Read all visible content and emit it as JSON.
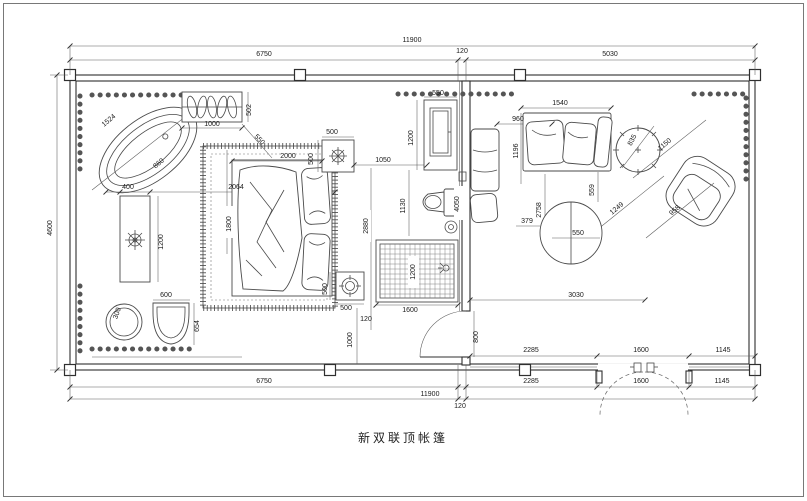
{
  "title": "新双联顶帐篷",
  "colors": {
    "line": "#2f2f2f",
    "dim_line": "#5a5a5a",
    "text": "#1a1a1a",
    "background": "#ffffff"
  },
  "dims": {
    "top_total": "11900",
    "top_left": "6750",
    "top_mid": "120",
    "top_right": "5030",
    "left_height": "4600",
    "bottom_left": "6750",
    "bottom_total": "11900",
    "bottom_mid": "120",
    "win_inner": [
      "2285",
      "1600",
      "1145"
    ],
    "win_outer": [
      "2285",
      "1600",
      "1145"
    ]
  },
  "interior": {
    "tub_length": "1524",
    "tub_width": "860",
    "rack_width": "1000",
    "rack_depth": "502",
    "rack_offset": "550",
    "console_width": "400",
    "console_length": "1200",
    "console_to_bed": "2064",
    "carpet_length": "1800",
    "pouf_dia": "300",
    "seat_width": "600",
    "seat_depth": "654",
    "bed_width": "2000",
    "nightstand_width": "500",
    "nightstand_depth": "500",
    "bed_to_vanity": "1050",
    "vanity_width": "550",
    "mirror_height": "1200",
    "toilet_clear": "1130",
    "bed_length": "2880",
    "shower_width": "1600",
    "shower_depth": "1200",
    "stool_width": "500",
    "stool_depth": "500",
    "foot_gap": "120",
    "foot_clear": "1000",
    "door_width": "800",
    "partition_length": "4050",
    "sofa_width": "1540",
    "chaise_width": "960",
    "chaise_depth": "1196",
    "living_depth": "2758",
    "sofa_gap": "379",
    "side_table_dia": "835",
    "armchair_width": "1150",
    "armchair_depth": "958",
    "armchair_to_table": "1249",
    "table_gap": "559",
    "table_dia": "550",
    "living_width": "3030"
  }
}
